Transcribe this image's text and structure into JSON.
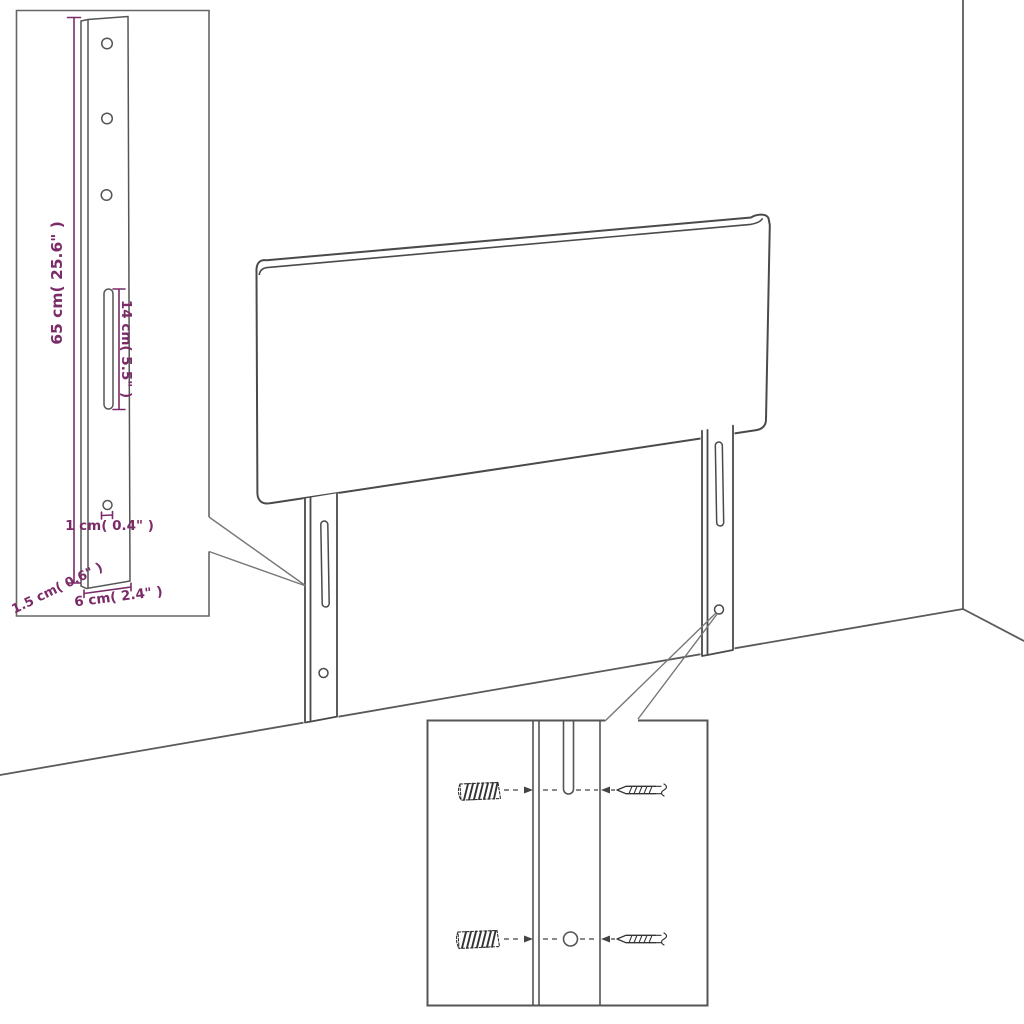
{
  "diagram": {
    "kind": "headboard-assembly-dimension-diagram"
  },
  "colors": {
    "dimension": "#7b2c68",
    "outline": "#4a4a4a",
    "room_line": "#5a5a5a",
    "fastener": "#333333",
    "background": "#ffffff"
  },
  "labels": {
    "leg_height": "65 cm( 25.6\" )",
    "slot_length": "14 cm( 5.5\" )",
    "hole_diameter": "1 cm( 0.4\" )",
    "side_thickness": "1.5 cm( 0.6\" )",
    "leg_width": "6 cm( 2.4\" )"
  }
}
